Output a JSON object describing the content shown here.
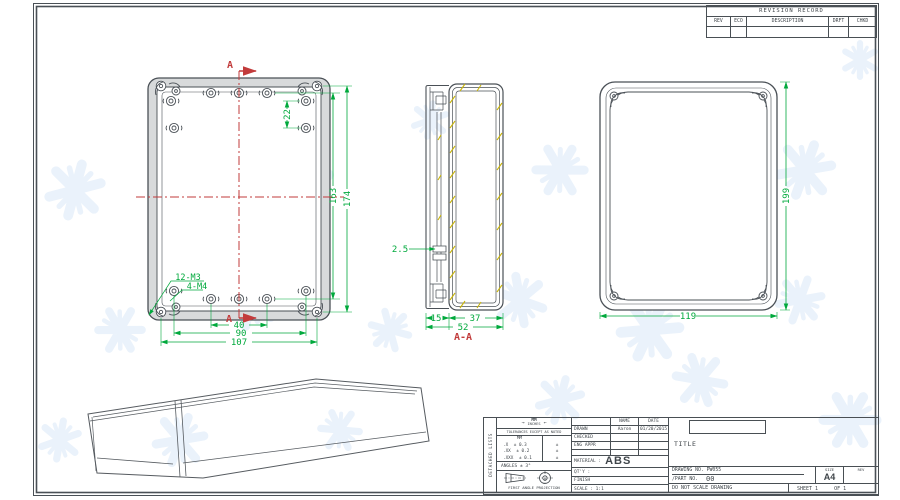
{
  "sheet": {
    "revision_table": {
      "title": "REVISION RECORD",
      "columns": [
        "REV",
        "ECO",
        "DESCRIPTION",
        "DRFT",
        "CHKD"
      ]
    },
    "side_strip_label": "DETACHED LISTS"
  },
  "views": {
    "front": {
      "section_marker": "A",
      "dims": {
        "hole_pair_spacing": "22",
        "hole_span_v": "163",
        "hole_span_v_outer": "174",
        "bottom_inner": "40",
        "bottom_mid": "90",
        "bottom_outer": "107"
      },
      "labels": {
        "m3": "12-M3",
        "m4": "4-M4"
      }
    },
    "section": {
      "label": "A-A",
      "dims": {
        "wall": "2.5",
        "lid_depth": "15",
        "body_depth": "37",
        "total_depth": "52"
      }
    },
    "top": {
      "dims": {
        "width": "119",
        "height": "199"
      }
    }
  },
  "title_block": {
    "units": {
      "primary": "MM",
      "secondary": "INCHES"
    },
    "tolerances": {
      "heading": "TOLERANCES EXCEPT AS NOTED",
      "col_header": "MM",
      "rows": [
        {
          "range": ".X",
          "value": "± 0.3"
        },
        {
          "range": ".XX",
          "value": "± 0.2"
        },
        {
          "range": ".XXX",
          "value": "± 0.1"
        }
      ],
      "secondary_mark": "±",
      "angles": "ANGLES ± 3°"
    },
    "projection_label": "FIRST ANGLE PROJECTION",
    "approvals": {
      "name_header": "NAME",
      "date_header": "DATE",
      "rows": [
        {
          "label": "DRAWN",
          "name": "Aaron",
          "date": "01/20/2015"
        },
        {
          "label": "CHECKED",
          "name": "",
          "date": ""
        },
        {
          "label": "ENG APPR",
          "name": "",
          "date": ""
        }
      ]
    },
    "material_label": "MATERIAL :",
    "material_value": "ABS",
    "qty_label": "QT'Y :",
    "finish_label": "FINISH",
    "scale_label": "SCALE : 1:1",
    "title_label": "TITLE",
    "drawing_no": "DRAWING NO. PW055",
    "part_no_label": "/PART NO.",
    "part_no_value": "00",
    "size_label": "SIZE",
    "size_value": "A4",
    "rev_label": "REV",
    "do_not_scale": "DO NOT SCALE DRAWING",
    "sheet_label": "SHEET 1",
    "of_label": "OF 1"
  },
  "colors": {
    "dimension": "#00a93c",
    "section_marker": "#c23b3b",
    "drawing_line": "#4a5056",
    "hatch": "#c9b50a",
    "watermark": "#d9e8f7"
  }
}
